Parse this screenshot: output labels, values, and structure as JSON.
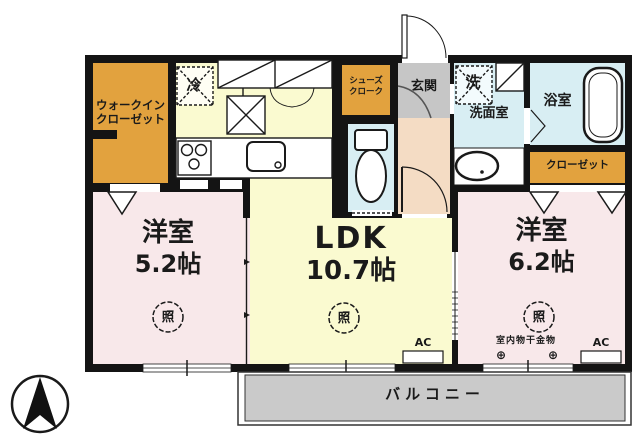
{
  "plan_title": "apartment-floor-plan",
  "rooms": {
    "walkin_closet": {
      "label_line1": "ウォークイン",
      "label_line2": "クローゼット"
    },
    "shoes_cloak": {
      "label_line1": "シューズ",
      "label_line2": "クローク"
    },
    "entrance": {
      "label": "玄関"
    },
    "washroom": {
      "label": "洗面室"
    },
    "bathroom": {
      "label": "浴室"
    },
    "closet": {
      "label": "クローゼット"
    },
    "bedroom1": {
      "name": "洋室",
      "size": "5.2帖"
    },
    "ldk": {
      "name": "LDK",
      "size": "10.7帖"
    },
    "bedroom2": {
      "name": "洋室",
      "size": "6.2帖"
    },
    "balcony": {
      "label": "バルコニー"
    }
  },
  "fixtures": {
    "fridge": "冷",
    "washer": "洗",
    "ceiling_light": "照",
    "air_conditioner": "AC",
    "indoor_drying_hardware": "室内物干金物",
    "hook_symbol": "⊕"
  },
  "colors": {
    "wall": "#141414",
    "storage_orange": "#E2A23E",
    "ldk_yellow": "#FAFAD0",
    "bedroom_pink": "#F8E8EA",
    "wet_area_blue": "#D8EEF3",
    "entrance_gray": "#C6C6C6",
    "hallway_peach": "#F4DCC4",
    "balcony_gray": "#CACACA"
  }
}
